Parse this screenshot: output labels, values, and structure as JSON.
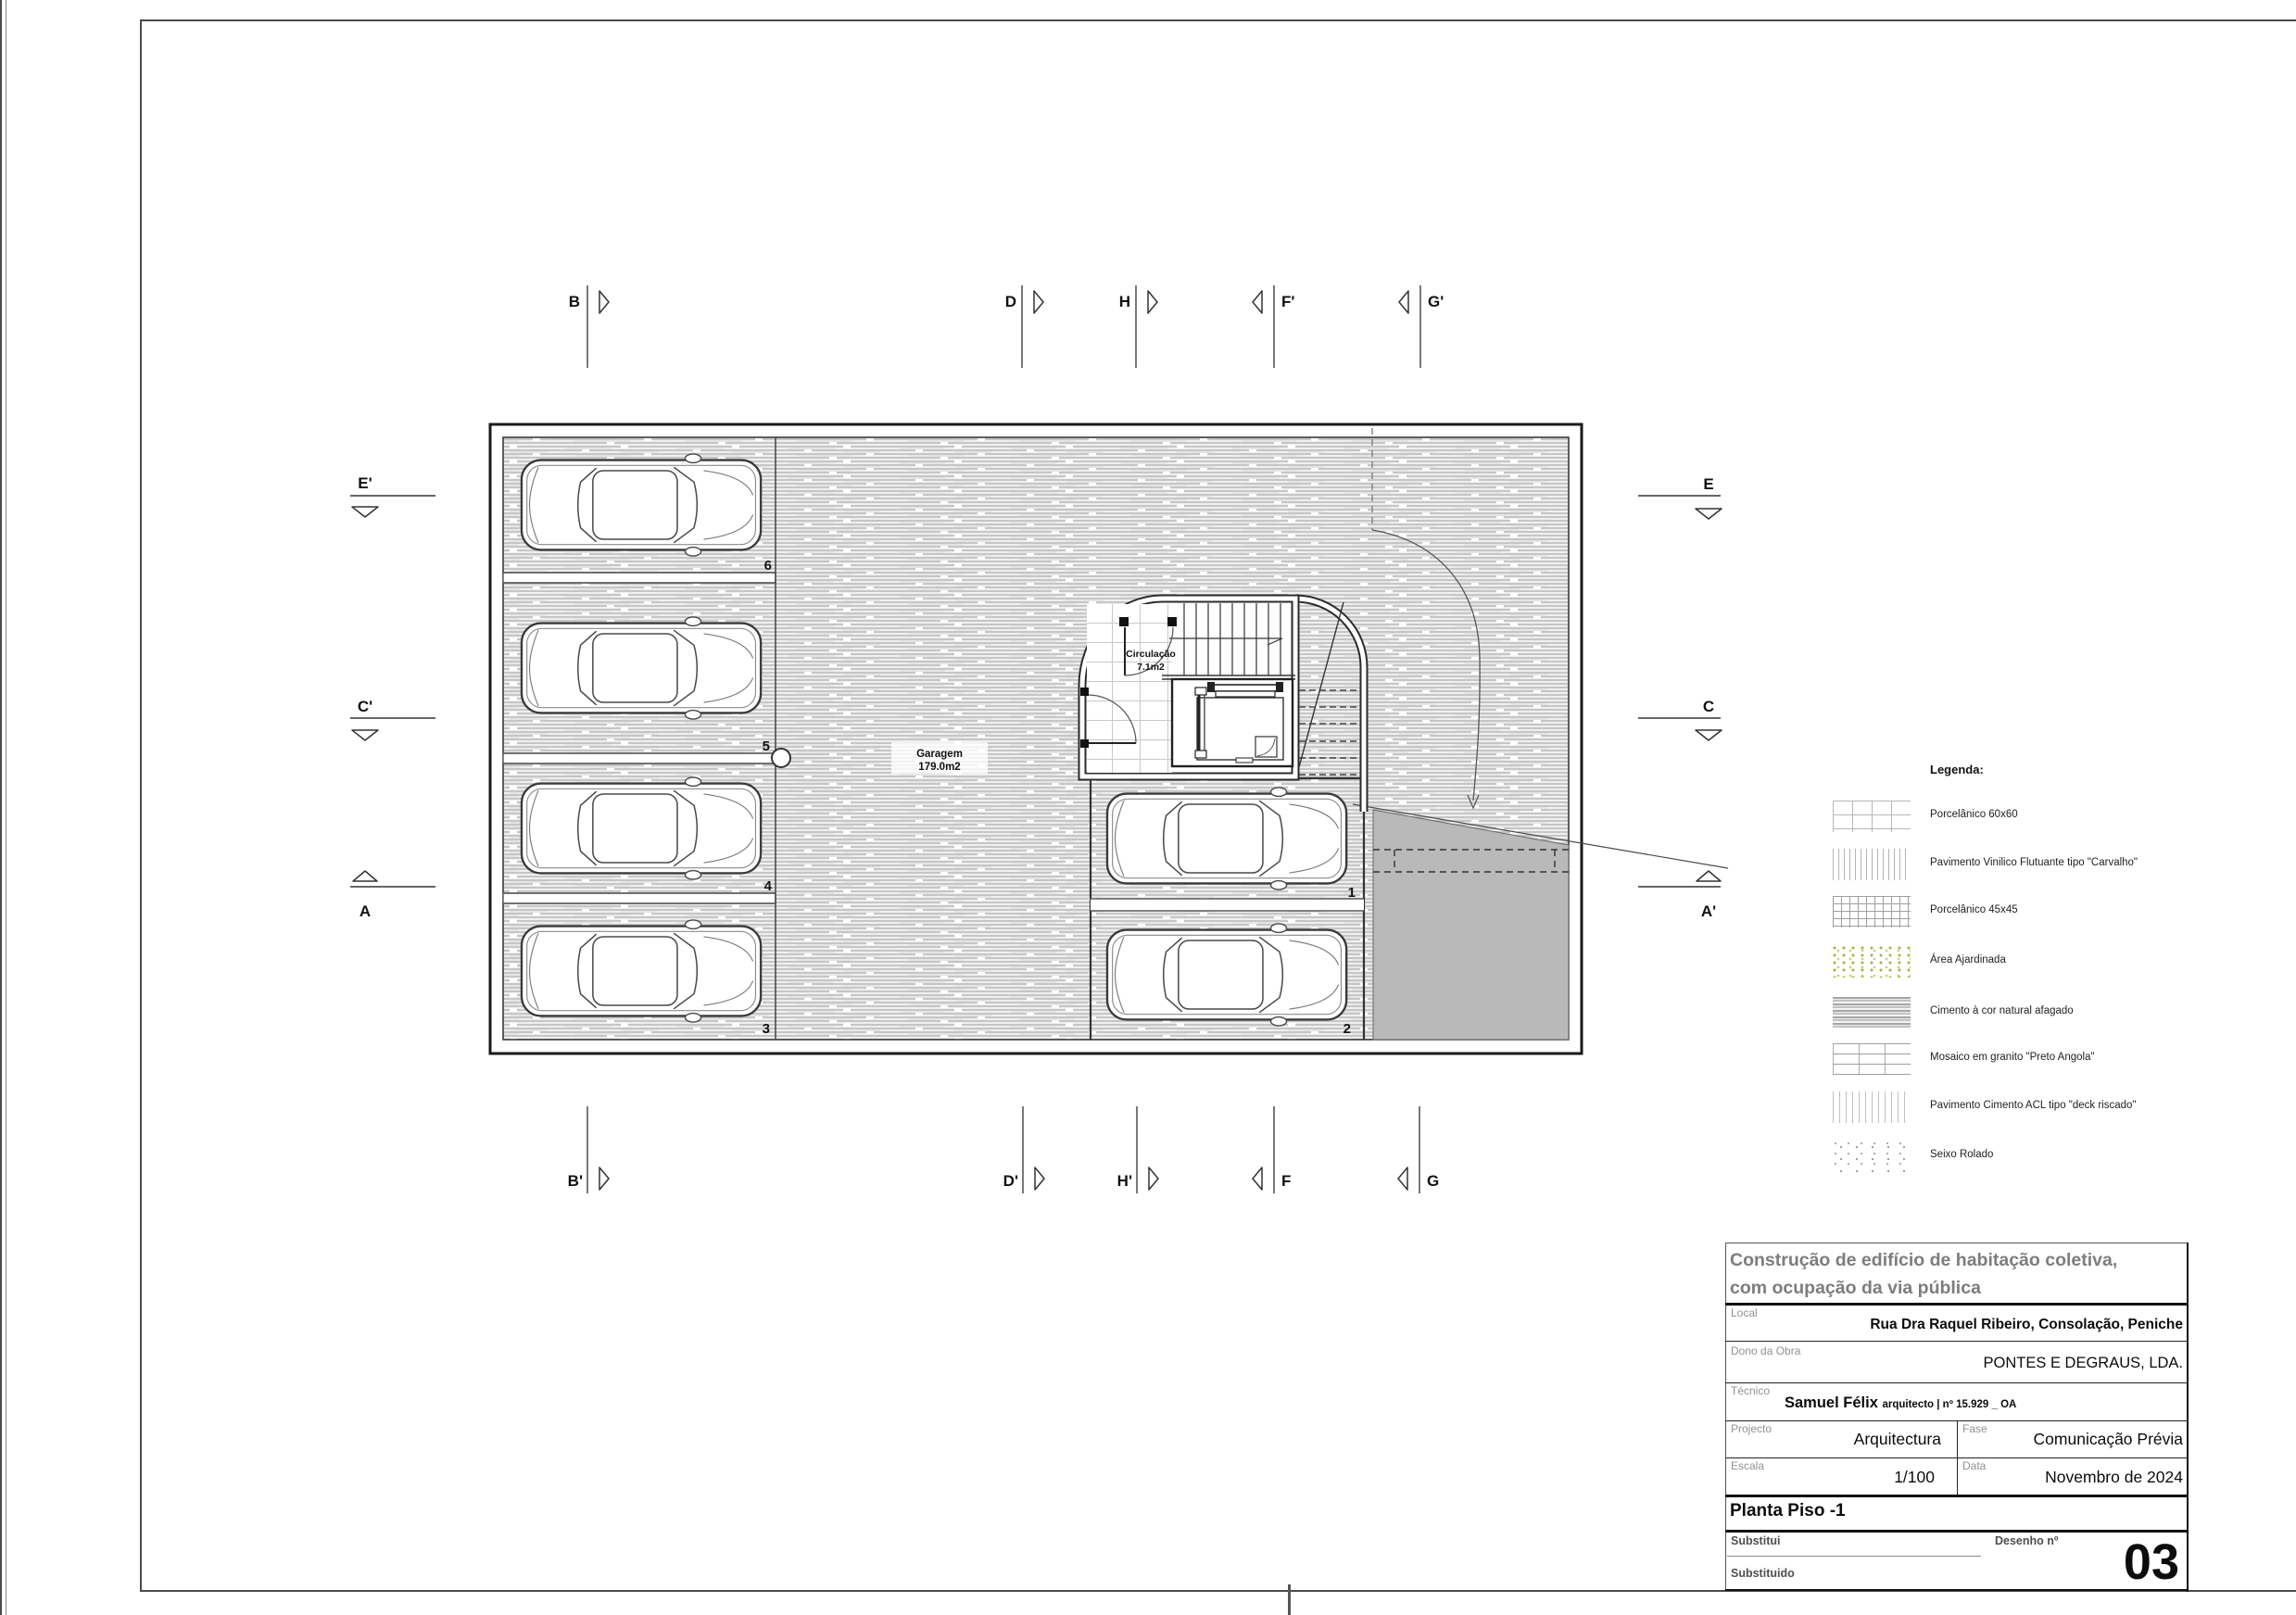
{
  "plan": {
    "garage_label": "Garagem",
    "garage_area": "179.0m2",
    "circulation_label": "Circulação",
    "circulation_area": "7.1m2",
    "stall_numbers": [
      "6",
      "5",
      "4",
      "3",
      "1",
      "2"
    ]
  },
  "section_markers": {
    "top": [
      "B",
      "D",
      "H",
      "F'",
      "G'"
    ],
    "bottom": [
      "B'",
      "D'",
      "H'",
      "F",
      "G"
    ],
    "left": [
      "E'",
      "C'",
      "A"
    ],
    "right": [
      "E",
      "C",
      "A'"
    ]
  },
  "legend": {
    "title": "Legenda:",
    "items": [
      {
        "label": "Porcelânico 60x60",
        "swatch": "grid-60"
      },
      {
        "label": "Pavimento Vinilico Flutuante tipo \"Carvalho\"",
        "swatch": "vertical-lines"
      },
      {
        "label": "Porcelânico 45x45",
        "swatch": "grid-45"
      },
      {
        "label": "Área Ajardinada",
        "swatch": "green-dots"
      },
      {
        "label": "Cimento à cor natural afagado",
        "swatch": "cement-streaks"
      },
      {
        "label": "Mosaico em granito \"Preto Angola\"",
        "swatch": "granite-brick"
      },
      {
        "label": "Pavimento Cimento ACL tipo \"deck riscado\"",
        "swatch": "deck-lines"
      },
      {
        "label": "Seixo Rolado",
        "swatch": "pebble-dots"
      }
    ]
  },
  "title_block": {
    "project_title_line1": "Construção de edifício de habitação coletiva,",
    "project_title_line2": "com ocupação da via pública",
    "local_label": "Local",
    "local_value": "Rua Dra Raquel Ribeiro, Consolação, Peniche",
    "owner_label": "Dono da Obra",
    "owner_value": "PONTES E DEGRAUS, LDA.",
    "technician_label": "Técnico",
    "technician_name": "Samuel Félix",
    "technician_credentials": "arquitecto | nº 15.929 _ OA",
    "project_label": "Projecto",
    "project_value": "Arquitectura",
    "phase_label": "Fase",
    "phase_value": "Comunicação Prévia",
    "scale_label": "Escala",
    "scale_value": "1/100",
    "date_label": "Data",
    "date_value": "Novembro de 2024",
    "drawing_title": "Planta Piso -1",
    "substitutes_label": "Substitui",
    "substituted_label": "Substituido",
    "drawing_number_label": "Desenho nº",
    "drawing_number_value": "03"
  },
  "colors": {
    "ramp_gray": "#b9b9b9",
    "garden_green": "#9fb83c",
    "title_gray": "#7d7d7d",
    "line_dark": "#2b2b2b"
  }
}
